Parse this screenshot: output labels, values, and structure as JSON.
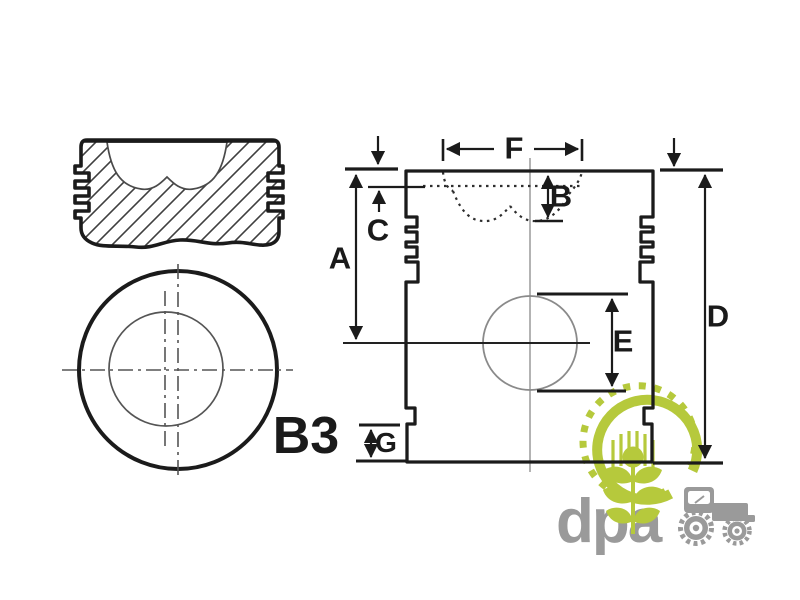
{
  "diagram": {
    "description": "piston dimension drawing",
    "dimension_labels": {
      "A": "A",
      "B": "B",
      "C": "C",
      "D": "D",
      "E": "E",
      "F": "F",
      "G": "G"
    },
    "part_label": "B3"
  },
  "logo": {
    "text": "dpa"
  },
  "colors": {
    "line": "#1b1b1b",
    "thin_line": "#555555",
    "centerline_gray": "#8a8a8a",
    "logo_green": "#b6c93c",
    "logo_gray": "#9a9a9a",
    "background": "#ffffff"
  }
}
